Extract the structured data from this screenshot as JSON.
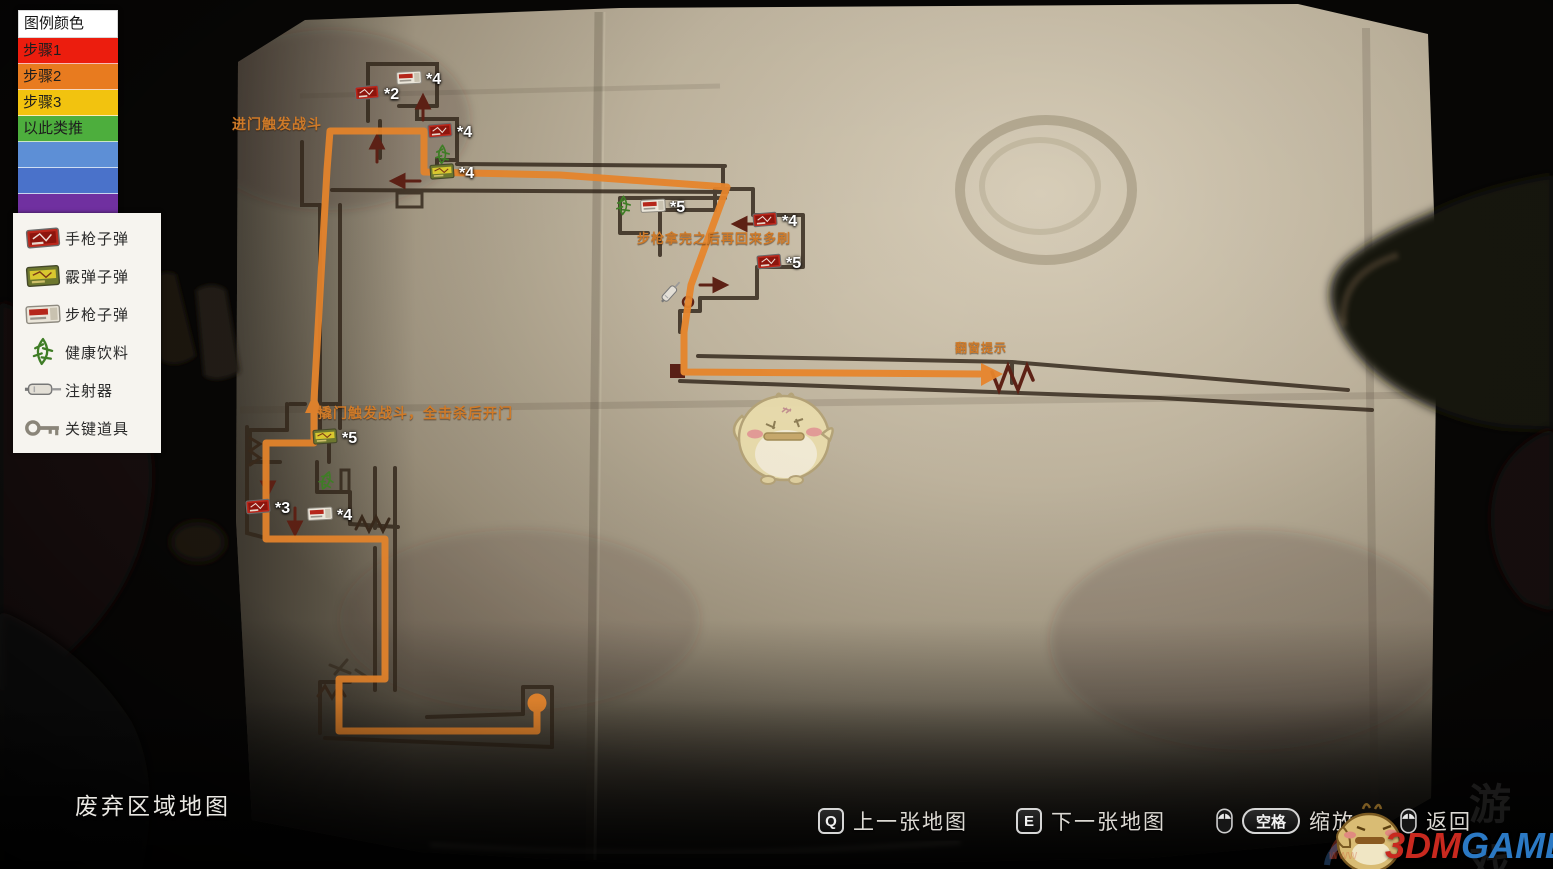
{
  "legend": {
    "title": "图例颜色",
    "steps": [
      {
        "label": "步骤1",
        "color": "#ec1d0e"
      },
      {
        "label": "步骤2",
        "color": "#e87b1f"
      },
      {
        "label": "步骤3",
        "color": "#f2c30f"
      },
      {
        "label": "以此类推",
        "color": "#4dae3d"
      },
      {
        "label": "",
        "color": "#5d8fd6"
      },
      {
        "label": "",
        "color": "#4a72ca"
      },
      {
        "label": "",
        "color": "#7030a0"
      }
    ]
  },
  "items": [
    {
      "icon": "handgun-ammo",
      "label": "手枪子弹"
    },
    {
      "icon": "shotgun-ammo",
      "label": "霰弹子弹"
    },
    {
      "icon": "rifle-ammo",
      "label": "步枪子弹"
    },
    {
      "icon": "health-drink",
      "label": "健康饮料"
    },
    {
      "icon": "syringe",
      "label": "注射器"
    },
    {
      "icon": "key-item",
      "label": "关键道具"
    }
  ],
  "map": {
    "title": "废弃区域地图",
    "route_color": "#e8862c",
    "markers": [
      {
        "icon": "rifle-ammo",
        "count": "*4",
        "x": 409,
        "y": 77
      },
      {
        "icon": "handgun-ammo",
        "count": "*2",
        "x": 367,
        "y": 92
      },
      {
        "icon": "handgun-ammo",
        "count": "*4",
        "x": 440,
        "y": 130
      },
      {
        "icon": "health-drink",
        "count": "",
        "x": 447,
        "y": 152
      },
      {
        "icon": "shotgun-ammo",
        "count": "*4",
        "x": 442,
        "y": 171
      },
      {
        "icon": "health-drink",
        "count": "",
        "x": 628,
        "y": 203
      },
      {
        "icon": "rifle-ammo",
        "count": "*5",
        "x": 653,
        "y": 205
      },
      {
        "icon": "handgun-ammo",
        "count": "*4",
        "x": 765,
        "y": 219
      },
      {
        "icon": "handgun-ammo",
        "count": "*5",
        "x": 769,
        "y": 261
      },
      {
        "icon": "syringe",
        "count": "",
        "x": 673,
        "y": 291,
        "rot": -48
      },
      {
        "icon": "shotgun-ammo",
        "count": "*5",
        "x": 325,
        "y": 436
      },
      {
        "icon": "health-drink",
        "count": "",
        "x": 330,
        "y": 478,
        "rot": 18
      },
      {
        "icon": "handgun-ammo",
        "count": "*3",
        "x": 258,
        "y": 506
      },
      {
        "icon": "rifle-ammo",
        "count": "*4",
        "x": 320,
        "y": 513
      }
    ],
    "annotations": [
      {
        "text": "进门触发战斗",
        "x": 232,
        "y": 114,
        "size": 14
      },
      {
        "text": "步枪拿完之后再回来多刷",
        "x": 637,
        "y": 228,
        "size": 13
      },
      {
        "text": "翻窗提示",
        "x": 955,
        "y": 339,
        "size": 12
      },
      {
        "text": "撬门触发战斗，全击杀后开门",
        "x": 318,
        "y": 403,
        "size": 14
      }
    ]
  },
  "hints": [
    {
      "mouse": false,
      "key": "Q",
      "label": "上一张地图"
    },
    {
      "mouse": false,
      "key": "E",
      "label": "下一张地图"
    },
    {
      "mouse": true,
      "key": "空格",
      "label": "缩放"
    },
    {
      "mouse": true,
      "key": "",
      "label": "返回"
    }
  ],
  "watermark": {
    "brand_red": "3DM",
    "brand_blue": "GAME",
    "faint_text": "游戏",
    "url_fragment": "www"
  }
}
